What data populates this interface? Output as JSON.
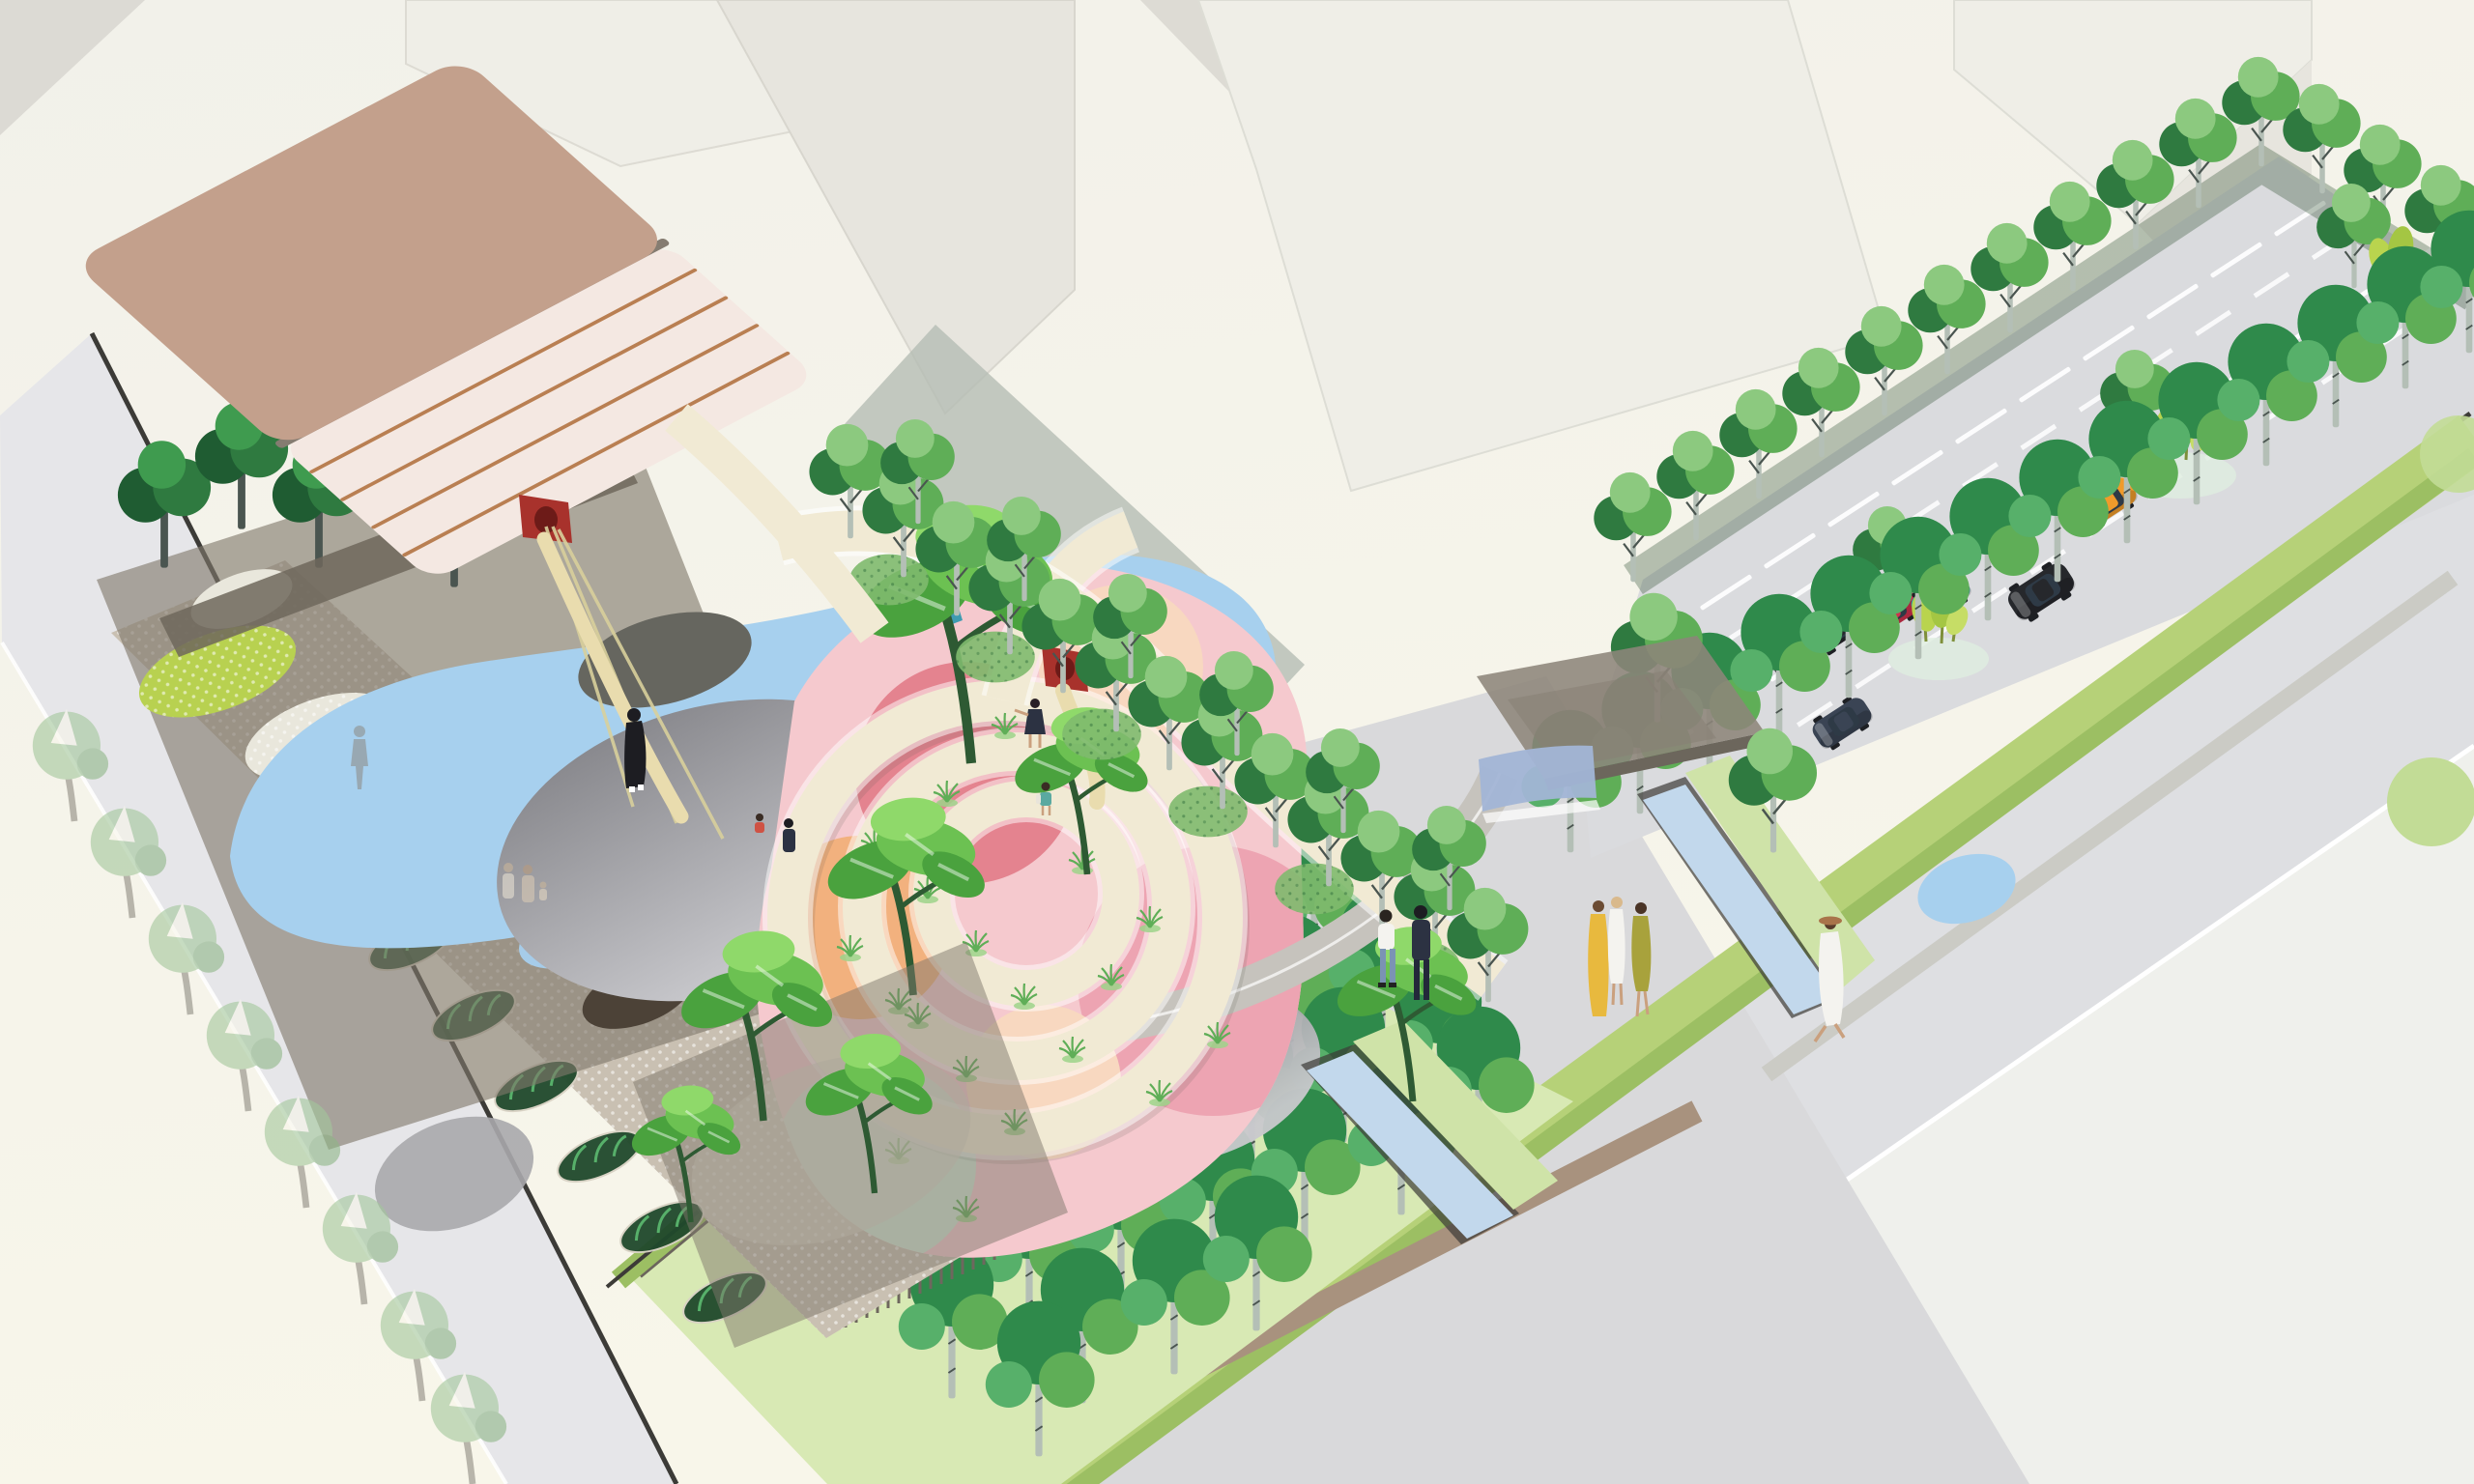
{
  "scene": {
    "type": "axonometric landscape-architecture site illustration",
    "areas": [
      "main-building-with-copper-roof",
      "canopy-garden",
      "spiral-playground",
      "water-pond",
      "gray-play-mounds",
      "birch-grove-lawn",
      "entry-pavilion",
      "plaza",
      "parking-lot",
      "street-left",
      "street-southeast",
      "water-rills"
    ],
    "features": [
      "tube-slide-from-building",
      "spiral-ramp",
      "elevated-walkway",
      "stepped-seating",
      "shrub-planters",
      "street-tree-rows",
      "hedge-band"
    ],
    "cars": [
      {
        "type": "sedan",
        "color_key": "car_yellow"
      },
      {
        "type": "sedan",
        "color_key": "car_black"
      },
      {
        "type": "sedan",
        "color_key": "car_red"
      },
      {
        "type": "sedan",
        "color_key": "car_teal"
      },
      {
        "type": "suv",
        "color_key": "car_black"
      },
      {
        "type": "sedan",
        "color_key": "car_orange"
      },
      {
        "type": "sedan-driving",
        "color_key": "car_navy"
      }
    ],
    "people": [
      "ghost-walker",
      "family-pair-with-child",
      "woman-black-dress",
      "girl-on-ramp",
      "child-with-backpack",
      "child-and-parent-at-spiral",
      "plaza-couple",
      "trio-of-women",
      "woman-white-dress-sun-hat"
    ]
  },
  "colors": {
    "bg_top": "#f2f1ea",
    "bg_ivory": "#f8f6ea",
    "blk_face": "#efeee7",
    "blk_side": "#e7e5de",
    "blk_dark": "#dddbd4",
    "blk_tri": "#dcdad4",
    "blk_sage": "#b5bdb4",
    "road": "#e6e6e9",
    "road_se": "#dedfe2",
    "sidewalk": "#eff0ec",
    "plaza": "#d9d9db",
    "curb_dark": "#3c3b37",
    "curb_white": "#ffffff",
    "roof": "#c3a08c",
    "roof_edge": "#857c71",
    "facade": "#f4e8e2",
    "copper": "#b97f52",
    "soffit": "#6f675c",
    "canopy": "#7f776b",
    "walkway": "#c9c0b2",
    "pave_lime": "#b8d150",
    "pave_white": "#e9e7dc",
    "pave_blue": "#a6cce9",
    "pave_brown": "#4c4237",
    "water": "#a7d0ee",
    "rill_water": "#c2d8ec",
    "rill_green": "#cfe3a8",
    "mound_hi": "#c9c9cd",
    "mound_lo": "#808084",
    "mound_shadow": "#66665f",
    "spiral": "#f1ead4",
    "steps_tan": "#c9b89a",
    "path_tan": "#a8927e",
    "path_gray": "#cbcbc5",
    "play_pink": "#f5c9ce",
    "play_rose": "#e4838f",
    "play_orange": "#f2b17e",
    "play_peach": "#f8d8c0",
    "play_mint": "#d2e8d6",
    "play_pink2": "#eda4b2",
    "slide_red": "#a8322c",
    "slide_red_dark": "#6d1b18",
    "slide_tube": "#e9dcae",
    "rope": "#d8cf9b",
    "grass": "#9ed489",
    "grass_dark": "#5fae57",
    "tree_dark": "#2f7a40",
    "tree_mid": "#5fae57",
    "tree_light": "#8cc97f",
    "tree_grove": "#2f8a4b",
    "tree_grove2": "#57b06a",
    "tree_pale": "#a3c79b",
    "leaf_a": "#4aa23e",
    "leaf_b": "#6cc152",
    "leaf_c": "#8fd96a",
    "trunk_birch": "#b4bfb6",
    "trunk_dark": "#4a5550",
    "trunk_gray": "#8e9894",
    "bush": "#7fba6e",
    "bush_lime": "#b9d44e",
    "lawn": "#d8e9b4",
    "lawn_strip": "#b6d178",
    "lawn_strip2": "#9cbf63",
    "hedge_green": "#c2dc96",
    "pavilion": "#8d857a",
    "pavilion_blue": "#a2b5d6",
    "car_yellow": "#f0b42a",
    "car_red": "#d0314e",
    "car_teal": "#2aa3a0",
    "car_black": "#26282c",
    "car_orange": "#f09b2b",
    "car_navy": "#3a4454",
    "ppl_black": "#1d1d22",
    "ppl_navy": "#2c3242",
    "ppl_white": "#f4f3ef",
    "ppl_jeans": "#7b93b4",
    "ppl_yellow": "#e8b93e",
    "ppl_olive": "#a8a23c",
    "ppl_skin": "#caa07e",
    "ppl_tan": "#c9b59a",
    "ppl_hat": "#a9744a",
    "ppl_teal": "#5aa9a0",
    "ppl_ghost": "#8a8178"
  }
}
